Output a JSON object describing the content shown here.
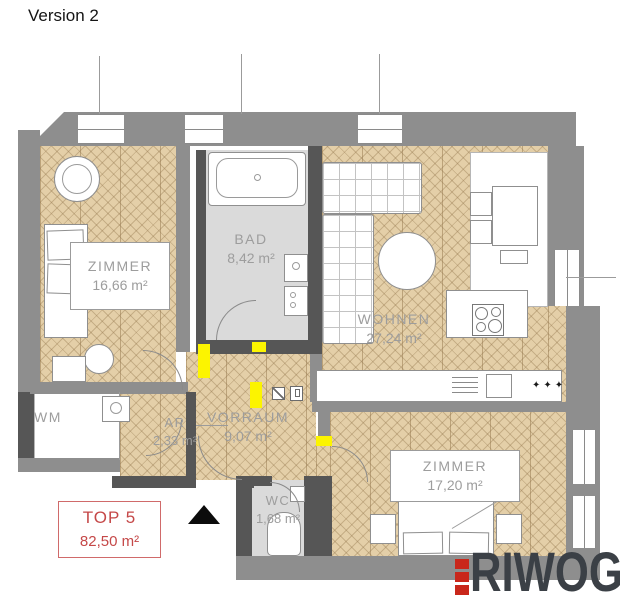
{
  "title": "Version 2",
  "rooms": {
    "zimmer1": {
      "name": "ZIMMER",
      "area": "16,66 m²"
    },
    "bad": {
      "name": "BAD",
      "area": "8,42 m²"
    },
    "wohnen": {
      "name": "WOHNEN",
      "area": "27,24 m²"
    },
    "vorraum": {
      "name": "VORRAUM",
      "area": "9,07 m²"
    },
    "ar": {
      "name": "AR",
      "area": "2,33 m²"
    },
    "wm": {
      "name": "WM"
    },
    "wc": {
      "name": "WC",
      "area": "1,68 m²"
    },
    "zimmer2": {
      "name": "ZIMMER",
      "area": "17,20 m²"
    }
  },
  "unit_badge": {
    "title": "TOP 5",
    "area": "82,50 m²"
  },
  "logo": {
    "text": "RIWOG"
  },
  "kitchen": {
    "counter_marks": "✦✦✦"
  },
  "colors": {
    "wall": "#8e8e8e",
    "wall_dark": "#565656",
    "wood": "#e4cfa8",
    "tile": "#dadada",
    "highlight": "#fcf400",
    "accent_red": "#c54848",
    "logo_gray": "#3b4046",
    "logo_red": "#c9271b"
  }
}
